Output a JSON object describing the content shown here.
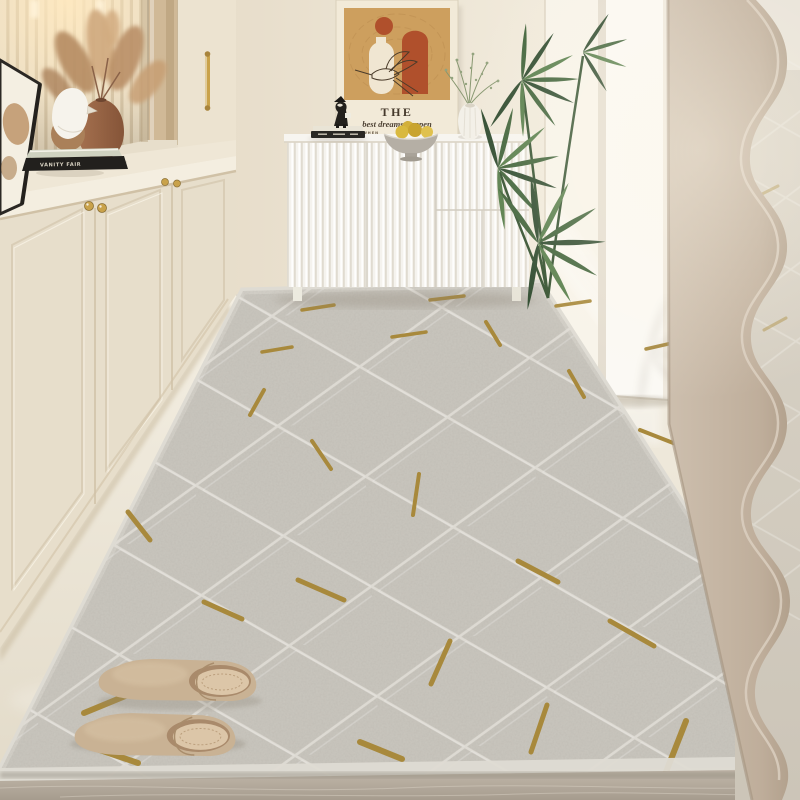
{
  "scene": {
    "description": "Bright cream entryway hallway: built-in cabinetry with lit display niche, white fluted sideboard under framed bird artwork, potted palm, wavy floor mirror, long grey geometric runner rug with gold accents, and a pair of tan slippers",
    "objects": [
      "built-in-cabinets",
      "display-niche",
      "pampas-grass-vase",
      "bird-figurine",
      "stacked-books",
      "leaning-frame",
      "framed-artwork",
      "fluted-sideboard",
      "fruit-bowl",
      "bud-vase",
      "palm-plant",
      "sunlit-wall",
      "wall-column",
      "wavy-mirror",
      "runner-rug",
      "slippers",
      "marble-floor"
    ]
  },
  "artwork": {
    "line1": "THE",
    "line2": "best dreams happen",
    "line3": "WHEN"
  },
  "books": {
    "spine_text": "VANITY FAIR"
  },
  "colors": {
    "wall": "#ece3d2",
    "wall-bright": "#f8f4eb",
    "cabinet": "#e7decb",
    "counter": "#f1e9d8",
    "gold": "#c9a24a",
    "sideboard": "#f4f2ec",
    "rug": "#d0cdc5",
    "rug-border": "#dedbd3",
    "rug-line": "#f2f0ea",
    "rug-gold": "#a8893c",
    "floor": "#ece4d4",
    "marble": "#b3a99c",
    "mirror-frame": "#c3b4a4",
    "mirror-glass": "#d3ccc0",
    "plant": "#3f6239",
    "plant-dark": "#2e4a2e",
    "slipper": "#c9b294",
    "slipper-insole": "#dcc6a8",
    "vase-brown": "#9c6a4c",
    "pampas": "#c49b72",
    "art-tan": "#cd9f5e",
    "art-rust": "#b0502c",
    "art-cream": "#f0e6d2"
  }
}
